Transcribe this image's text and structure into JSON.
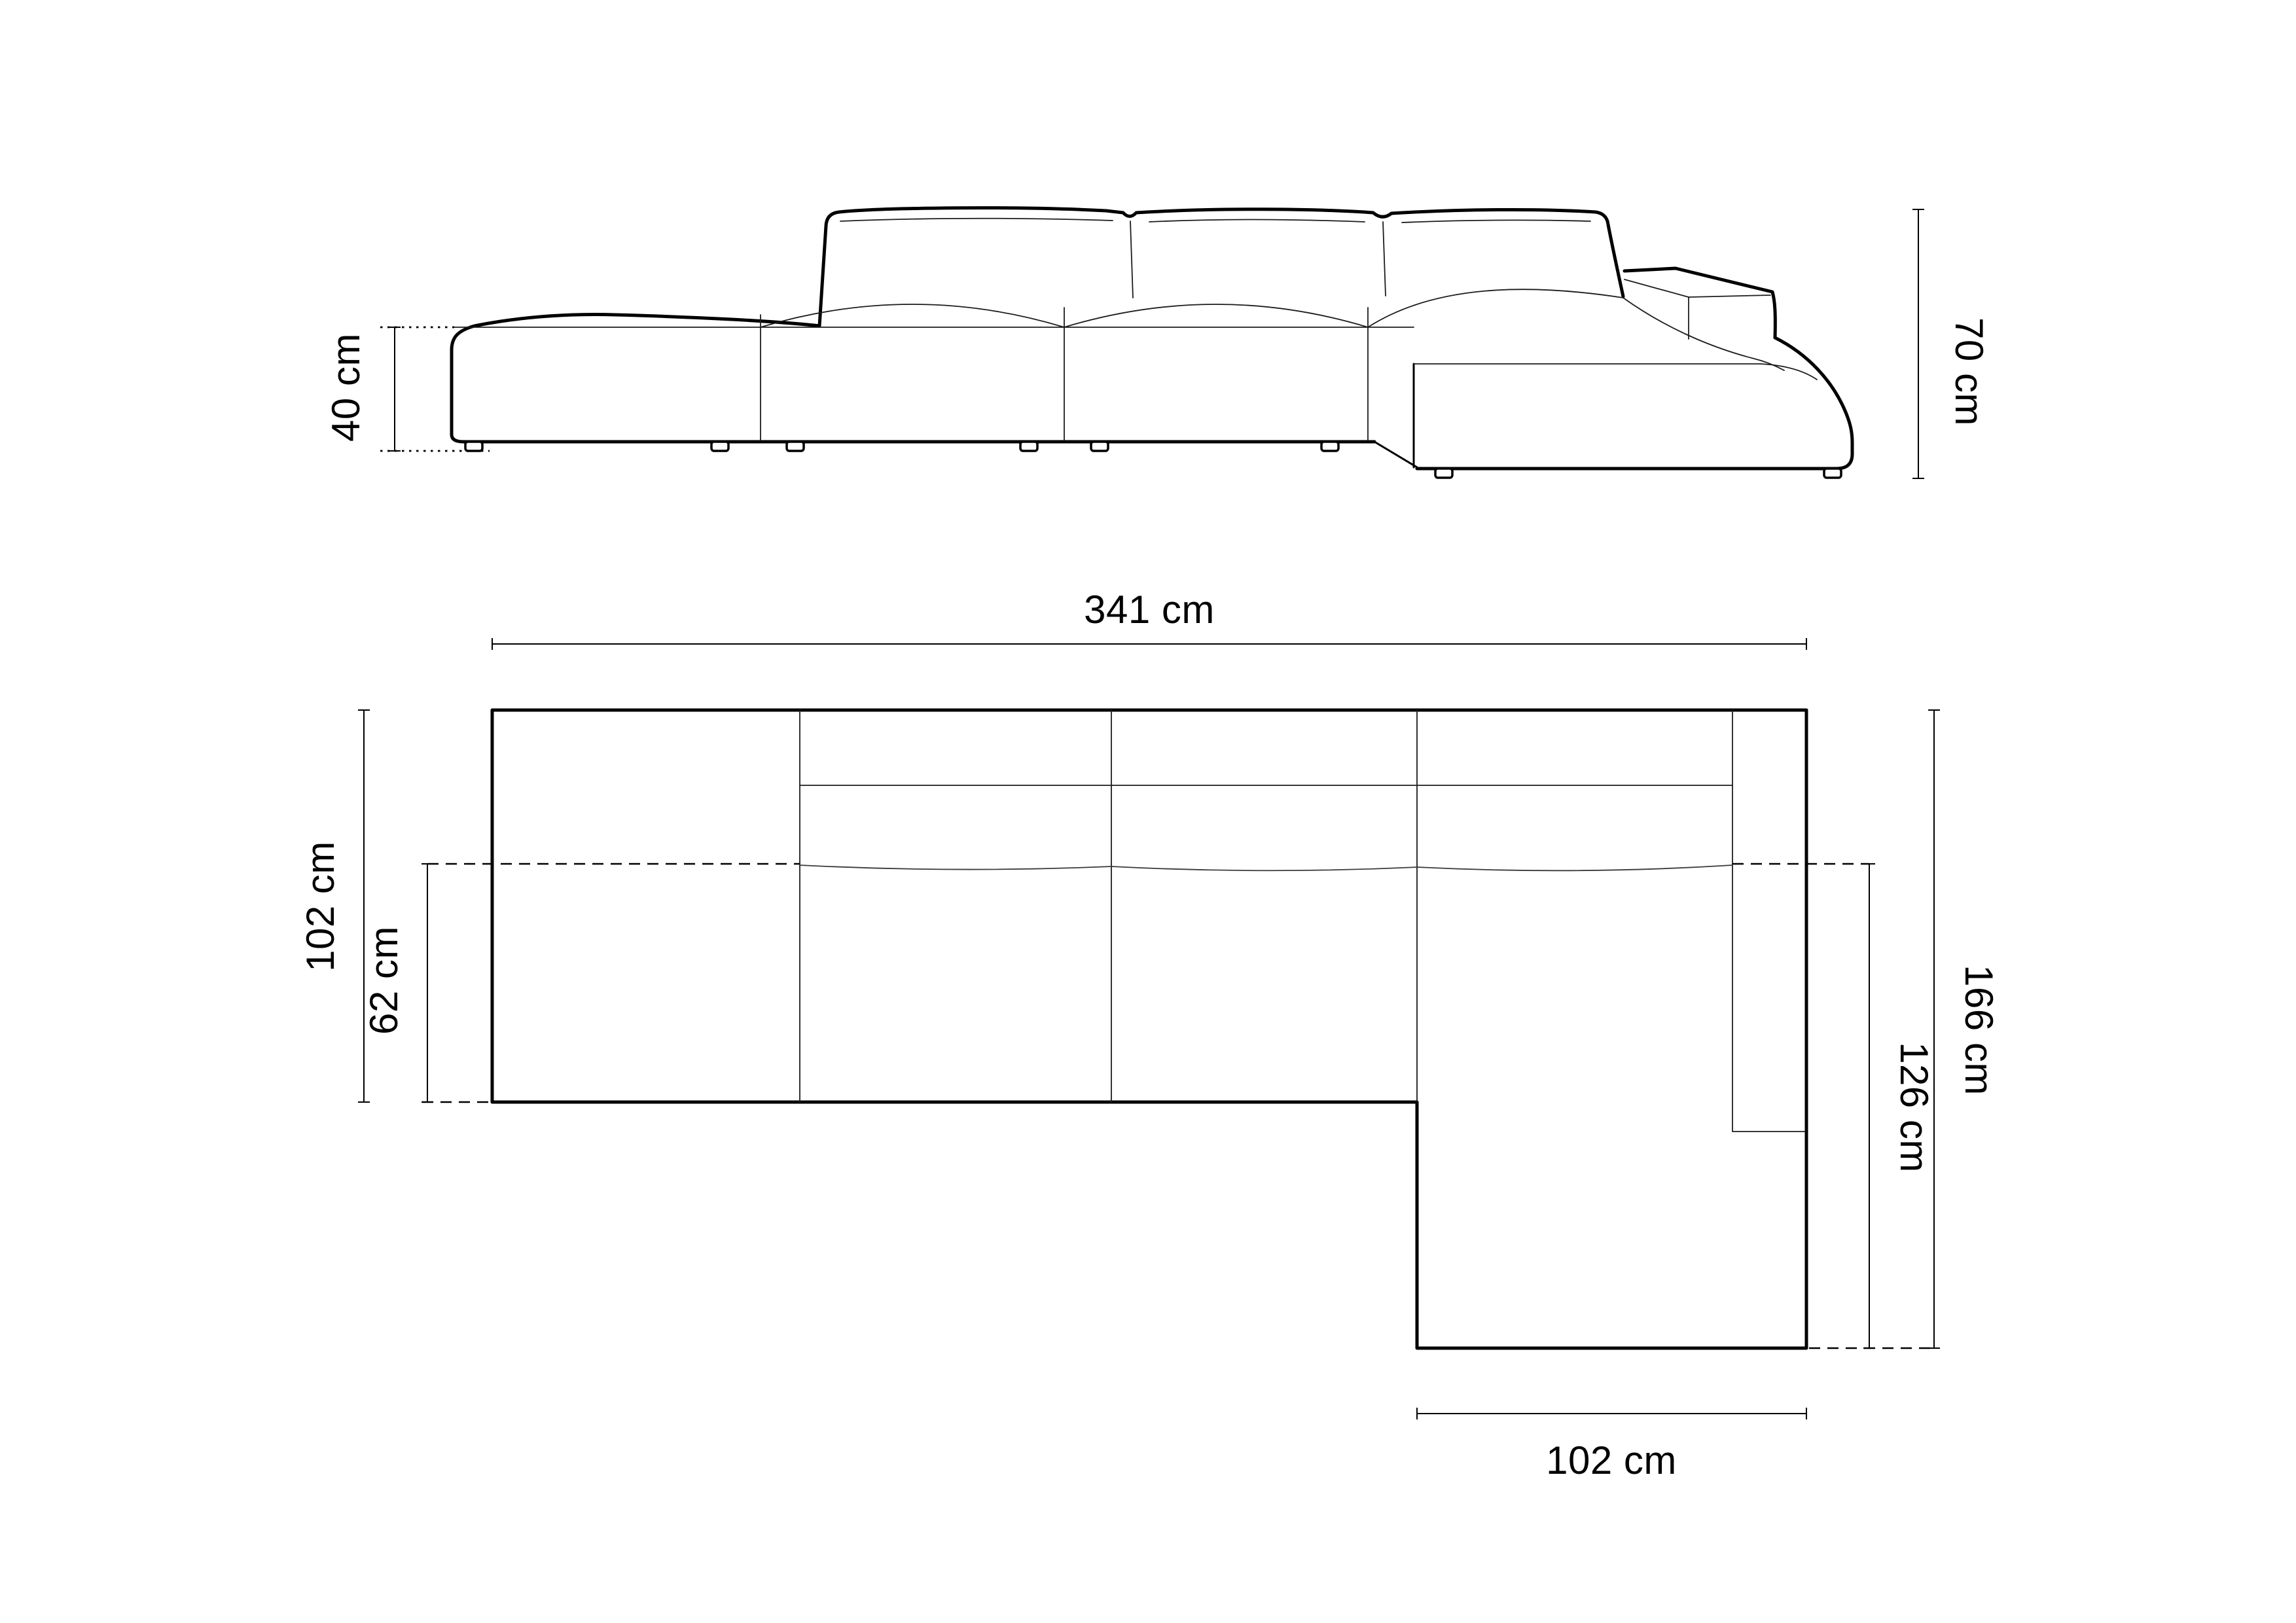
{
  "diagram": {
    "type": "sofa-dimension-technical-drawing",
    "unit": "cm",
    "side_view": {
      "labels": {
        "seat_height": "40 cm",
        "total_height": "70 cm"
      },
      "values": {
        "seat_height_cm": 40,
        "total_height_cm": 70
      }
    },
    "plan_view": {
      "labels": {
        "total_width": "341 cm",
        "main_depth": "102 cm",
        "seat_depth": "62 cm",
        "total_depth": "166 cm",
        "chaise_depth": "126 cm",
        "chaise_width": "102 cm"
      },
      "values": {
        "total_width_cm": 341,
        "main_depth_cm": 102,
        "seat_depth_cm": 62,
        "total_depth_cm": 166,
        "chaise_depth_cm": 126,
        "chaise_width_cm": 102
      }
    },
    "colors": {
      "line": "#000000",
      "background": "#ffffff"
    }
  }
}
